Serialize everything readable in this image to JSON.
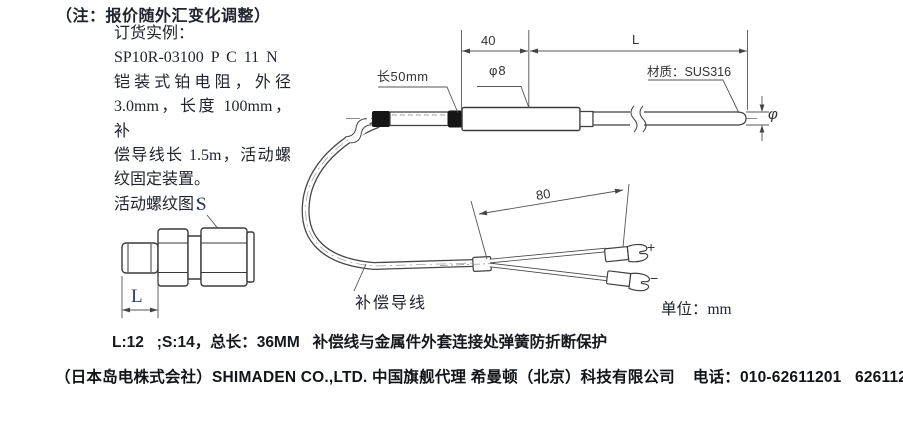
{
  "note": {
    "title": "（注：报价随外汇变化调整）",
    "lines": [
      "订货实例：",
      "SP10R-03100 P C 11 N",
      "铠装式铂电阻，外径",
      "3.0mm，长度 100mm，补",
      "偿导线长 1.5m，活动螺",
      "纹固定装置。",
      "活动螺纹图："
    ]
  },
  "fitting": {
    "s_label": "S",
    "l_label": "L"
  },
  "drawing": {
    "dim_40": "40",
    "dim_L": "L",
    "sleeve_length": "长50mm",
    "body_diameter": "φ8",
    "material": "材质：SUS316",
    "tip_diameter": "φ",
    "dim_80": "80",
    "comp_wire": "补偿导线",
    "plus": "+",
    "minus": "−",
    "units": "单位：mm"
  },
  "footer": {
    "spec": "L:12   ;S:14，总长：36MM   补偿线与金属件外套连接处弹簧防折断保护",
    "company": "（日本岛电株式会社）SHIMADEN CO.,LTD. 中国旗舰代理 希曼顿（北京）科技有限公司    电话：010-62611201   62611202"
  },
  "colors": {
    "text": "#20242e",
    "line": "#3f3f3f",
    "label_accent": "#2b3a66"
  }
}
